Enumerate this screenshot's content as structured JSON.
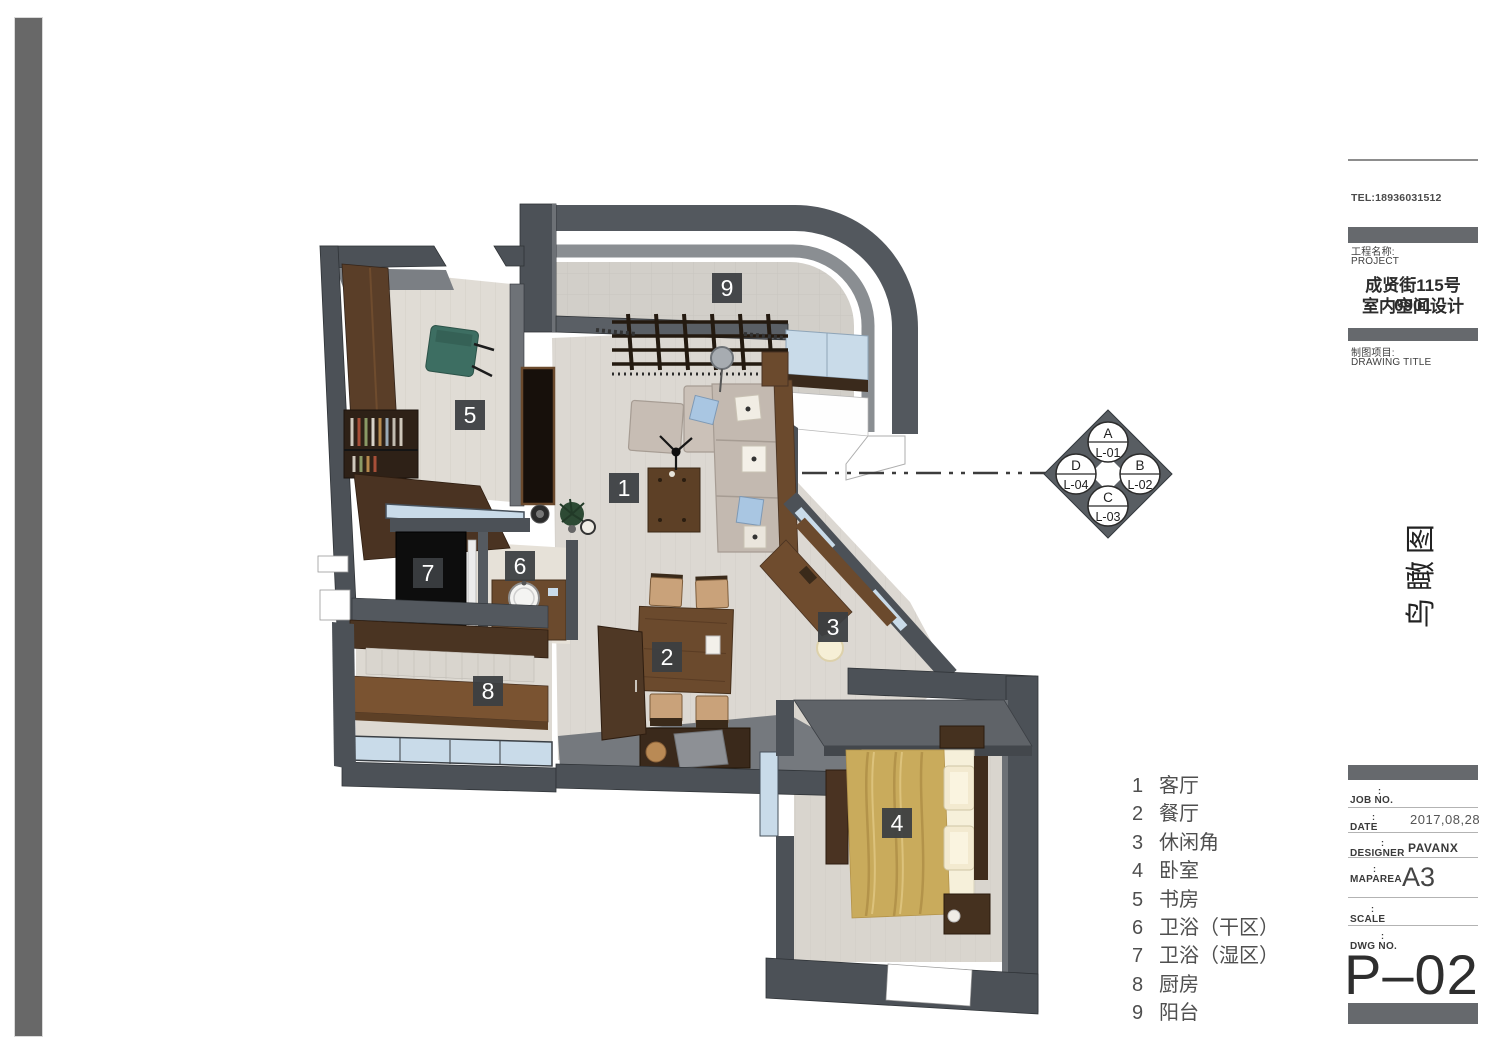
{
  "title_block": {
    "tel": "TEL:18936031512",
    "project_label_cn": "工程名称:",
    "project_label_en": "PROJECT",
    "project_name_line1": "成贤街115号0901",
    "project_name_line2": "室内空间设计",
    "drawing_label_cn": "制图项目:",
    "drawing_label_en": "DRAWING TITLE",
    "drawing_title_vertical": "鸟瞰图",
    "fields": [
      {
        "label": "JOB NO.",
        "colon": ":",
        "value": ""
      },
      {
        "label": "DATE",
        "colon": ":",
        "value": "2017,08,28"
      },
      {
        "label": "DESIGNER",
        "colon": ":",
        "value": "PAVANX"
      },
      {
        "label": "MAPAREA",
        "colon": ":",
        "value": "A3"
      },
      {
        "label": "SCALE",
        "colon": ":",
        "value": ""
      },
      {
        "label": "DWG NO.",
        "colon": ":",
        "value": ""
      }
    ],
    "dwg_number": "P–02",
    "colors": {
      "accent_bar": "#66696d",
      "separator": "#b3b3b3"
    }
  },
  "legend": {
    "rooms": [
      {
        "num": "1",
        "name": "客厅"
      },
      {
        "num": "2",
        "name": "餐厅"
      },
      {
        "num": "3",
        "name": "休闲角"
      },
      {
        "num": "4",
        "name": "卧室"
      },
      {
        "num": "5",
        "name": "书房"
      },
      {
        "num": "6",
        "name": "卫浴（干区）"
      },
      {
        "num": "7",
        "name": "卫浴（湿区）"
      },
      {
        "num": "8",
        "name": "厨房"
      },
      {
        "num": "9",
        "name": "阳台"
      }
    ]
  },
  "level_diamond": {
    "items": [
      {
        "letter": "A",
        "code": "L-01",
        "position": "top"
      },
      {
        "letter": "B",
        "code": "L-02",
        "position": "right"
      },
      {
        "letter": "C",
        "code": "L-03",
        "position": "bottom"
      },
      {
        "letter": "D",
        "code": "L-04",
        "position": "left"
      }
    ]
  },
  "plan": {
    "labels": [
      {
        "num": "1"
      },
      {
        "num": "2"
      },
      {
        "num": "3"
      },
      {
        "num": "4"
      },
      {
        "num": "5"
      },
      {
        "num": "6"
      },
      {
        "num": "7"
      },
      {
        "num": "8"
      },
      {
        "num": "9"
      }
    ],
    "colors": {
      "wall": "#4c5157",
      "wall_top": "#8a8e92",
      "floor": "#dcd8d2",
      "glass": "#c9dbe9",
      "wood_dark": "#4a3322",
      "wood": "#6b4a2d",
      "sofa": "#c3b9b0",
      "bed_blanket": "#c9ab5c",
      "label_bg": "#3b3f42",
      "wet_floor": "#0d0d0d",
      "chair_green": "#3d6e62"
    }
  }
}
